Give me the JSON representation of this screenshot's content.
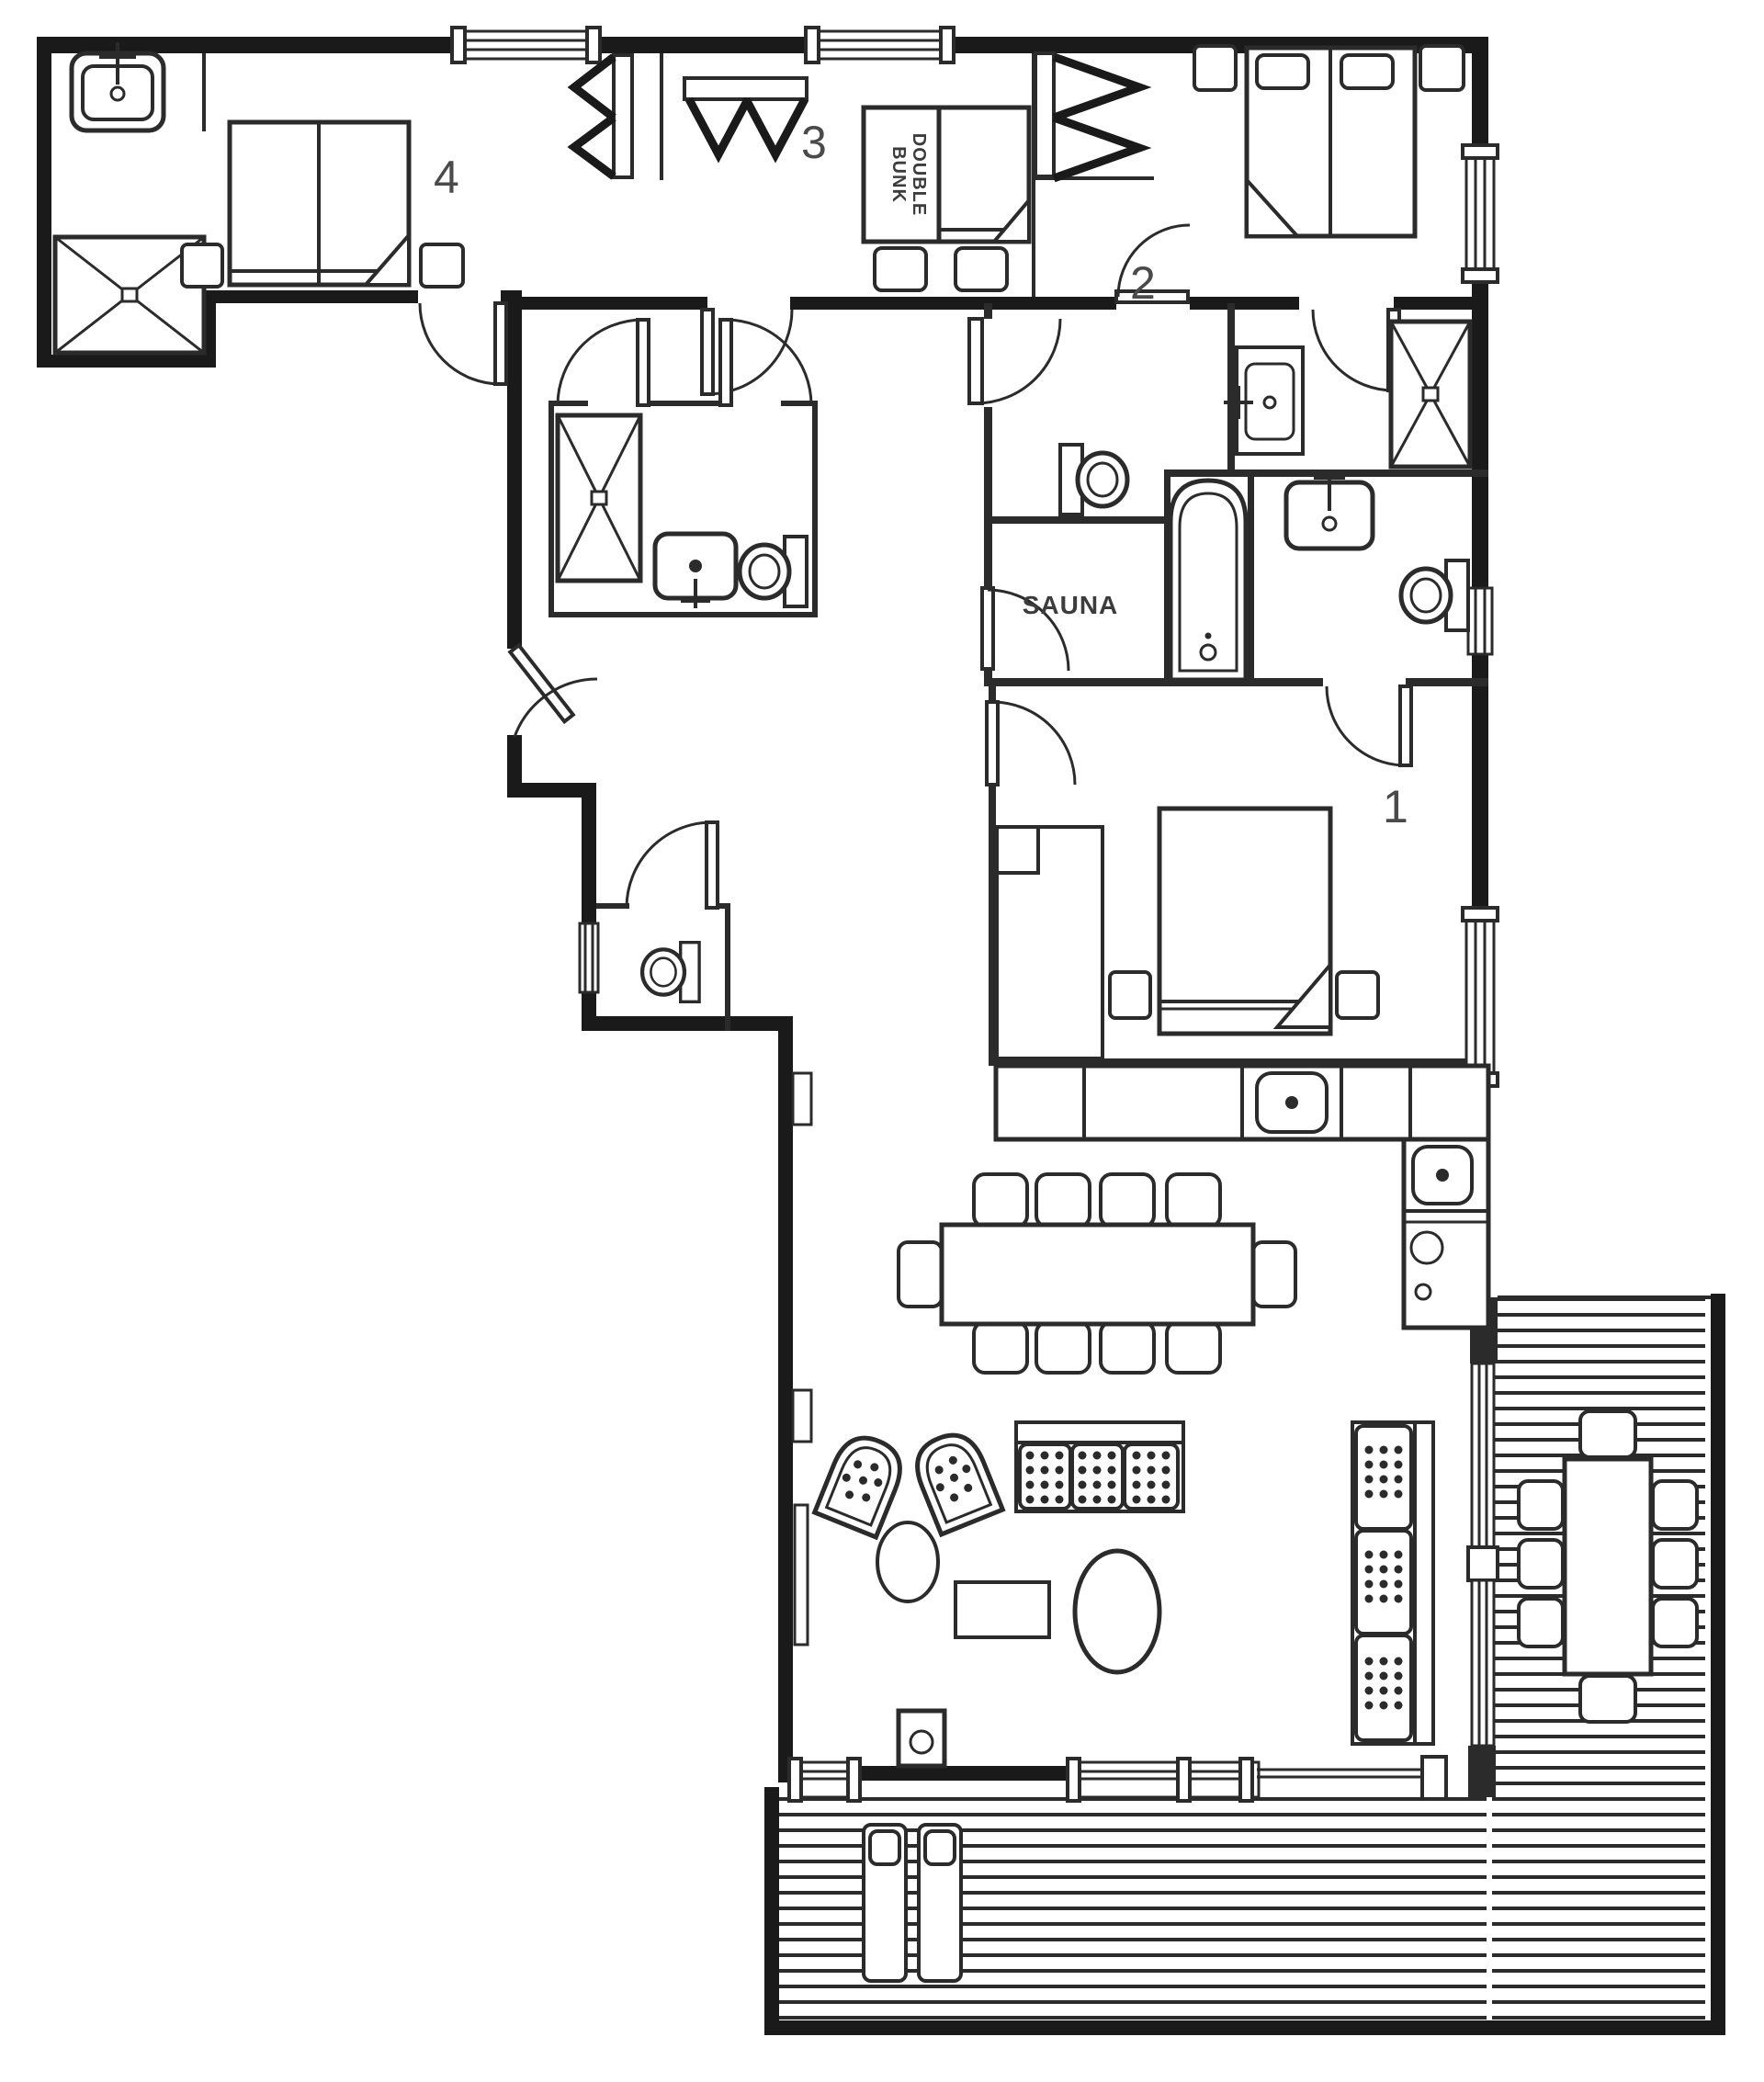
{
  "title": "Chalet floor plan",
  "rooms": {
    "bedroom_1": {
      "label": "1"
    },
    "bedroom_2": {
      "label": "2"
    },
    "bedroom_3": {
      "label": "3"
    },
    "bedroom_4": {
      "label": "4"
    },
    "sauna": {
      "label": "SAUNA"
    },
    "bedroom_3_bunk": {
      "line1": "DOUBLE",
      "line2": "BUNK"
    }
  },
  "colors": {
    "walls": "#1a1a1a",
    "lines": "#2b2b2b",
    "labels": "#4a4a4a",
    "background": "#ffffff"
  }
}
